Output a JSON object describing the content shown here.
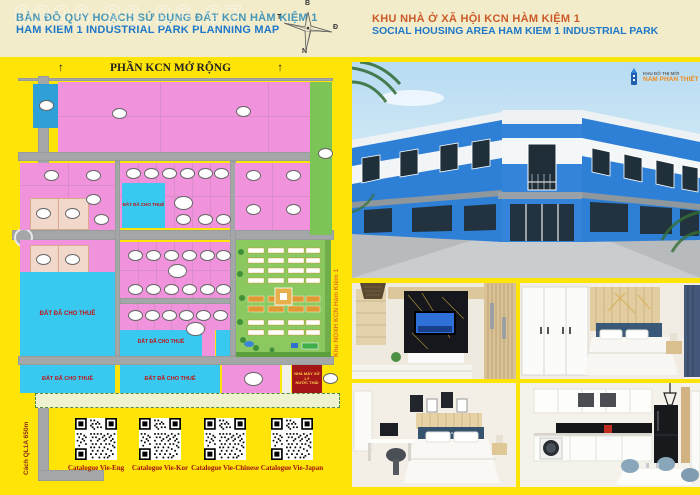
{
  "header": {
    "left_title_vi": "BẢN ĐỒ QUY HOẠCH SỬ DỤNG ĐẤT KCN HÀM KIỆM 1",
    "left_title_en": "HAM KIEM 1 INDUSTRIAL PARK PLANNING MAP",
    "right_title_vi": "KHU NHÀ Ở XÃ HỘI KCN HÀM KIỆM 1",
    "right_title_en": "SOCIAL HOUSING AREA HAM KIEM 1 INDUSTRIAL PARK",
    "watermark": "0396.96.96.97",
    "compass": {
      "north": "B",
      "east": "Đ",
      "south": "N",
      "west": "T"
    }
  },
  "map": {
    "top_label": "PHẦN KCN MỞ RỘNG",
    "arrow_glyph": "↑",
    "leased_label": "ĐẤT ĐÃ CHO THUÊ",
    "wastewater_line1": "NHÀ MÁY XỬ LÝ",
    "wastewater_line2": "NƯỚC THẢI",
    "left_road_label": "Cách QL1A 650m",
    "housing_strip_label": "Khu NOXH KCN Hàm Kiệm 1"
  },
  "qr": {
    "items": [
      {
        "label": "Catalogue Vie-Eng"
      },
      {
        "label": "Catalogue Vie-Kor"
      },
      {
        "label": "Catalogue Vie-Chinese"
      },
      {
        "label": "Catalogue Vie-Japan"
      }
    ]
  },
  "photos": {
    "logo_line1": "KHU ĐÔ THỊ MỚI",
    "logo_line2": "NAM PHAN THIẾT"
  },
  "colors": {
    "background": "#FFE408",
    "header_band": "#F2ECCB",
    "parcel_pink": "#F092DC",
    "parcel_cyan": "#38C8F0",
    "parcel_green": "#7CC455",
    "parcel_blue": "#2F9FD8",
    "parcel_red": "#A51616",
    "road_gray": "#A3A7A7",
    "title_blue": "#1F78C8",
    "title_teal": "#4596B8",
    "title_orange": "#CB5A28",
    "label_red": "#C01414",
    "building_blue": "#2E7FD6"
  }
}
